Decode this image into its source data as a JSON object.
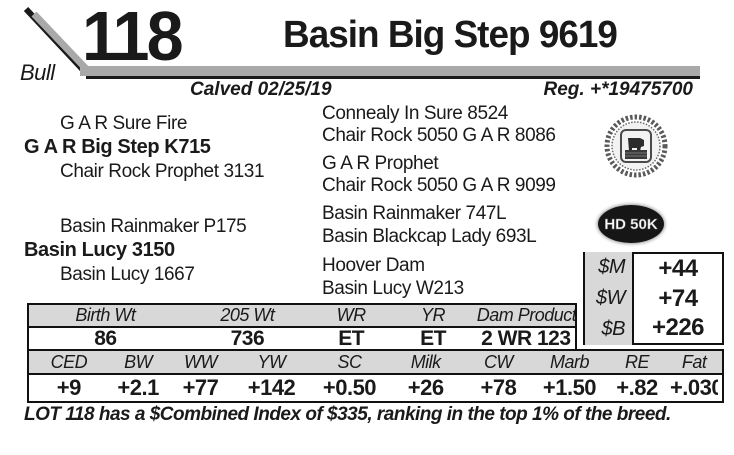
{
  "header": {
    "lot_number": "118",
    "sex": "Bull",
    "title": "Basin Big Step 9619",
    "calved": "Calved 02/25/19",
    "reg": "Reg. +*19475700"
  },
  "pedigree": {
    "sire": {
      "name": "G A R Big Step K715",
      "sire": "G A R Sure Fire",
      "dam": "Chair Rock Prophet 3131"
    },
    "dam": {
      "name": "Basin Lucy 3150",
      "sire": "Basin Rainmaker P175",
      "dam": "Basin Lucy 1667"
    },
    "paternal_grandparents": [
      "Connealy In Sure 8524",
      "Chair Rock 5050 G A R 8086",
      "G A R Prophet",
      "Chair Rock 5050 G A R 9099"
    ],
    "maternal_grandparents": [
      "Basin Rainmaker 747L",
      "Basin Blackcap Lady 693L",
      "Hoover Dam",
      "Basin Lucy W213"
    ]
  },
  "badges": {
    "seal_icon": "angus-association-seal",
    "hd50k_label": "HD 50K"
  },
  "dollar_values": {
    "rows": [
      {
        "label": "$M",
        "value": "+44"
      },
      {
        "label": "$W",
        "value": "+74"
      },
      {
        "label": "$B",
        "value": "+226"
      }
    ]
  },
  "weights_table": {
    "headers": [
      "Birth Wt",
      "205 Wt",
      "WR",
      "YR",
      "Dam Production"
    ],
    "values": [
      "86",
      "736",
      "ET",
      "ET",
      "2 WR 123"
    ]
  },
  "epd_table": {
    "headers": [
      "CED",
      "BW",
      "WW",
      "YW",
      "SC",
      "Milk",
      "CW",
      "Marb",
      "RE",
      "Fat"
    ],
    "values": [
      "+9",
      "+2.1",
      "+77",
      "+142",
      "+0.50",
      "+26",
      "+78",
      "+1.50",
      "+.82",
      "+.030"
    ]
  },
  "footnote": "LOT 118 has a $Combined Index of $335, ranking in the top 1% of the breed.",
  "colors": {
    "bar_gray": "#a9a9a9",
    "row_gray": "#d8d8d8",
    "text_black": "#1a1a1a"
  }
}
